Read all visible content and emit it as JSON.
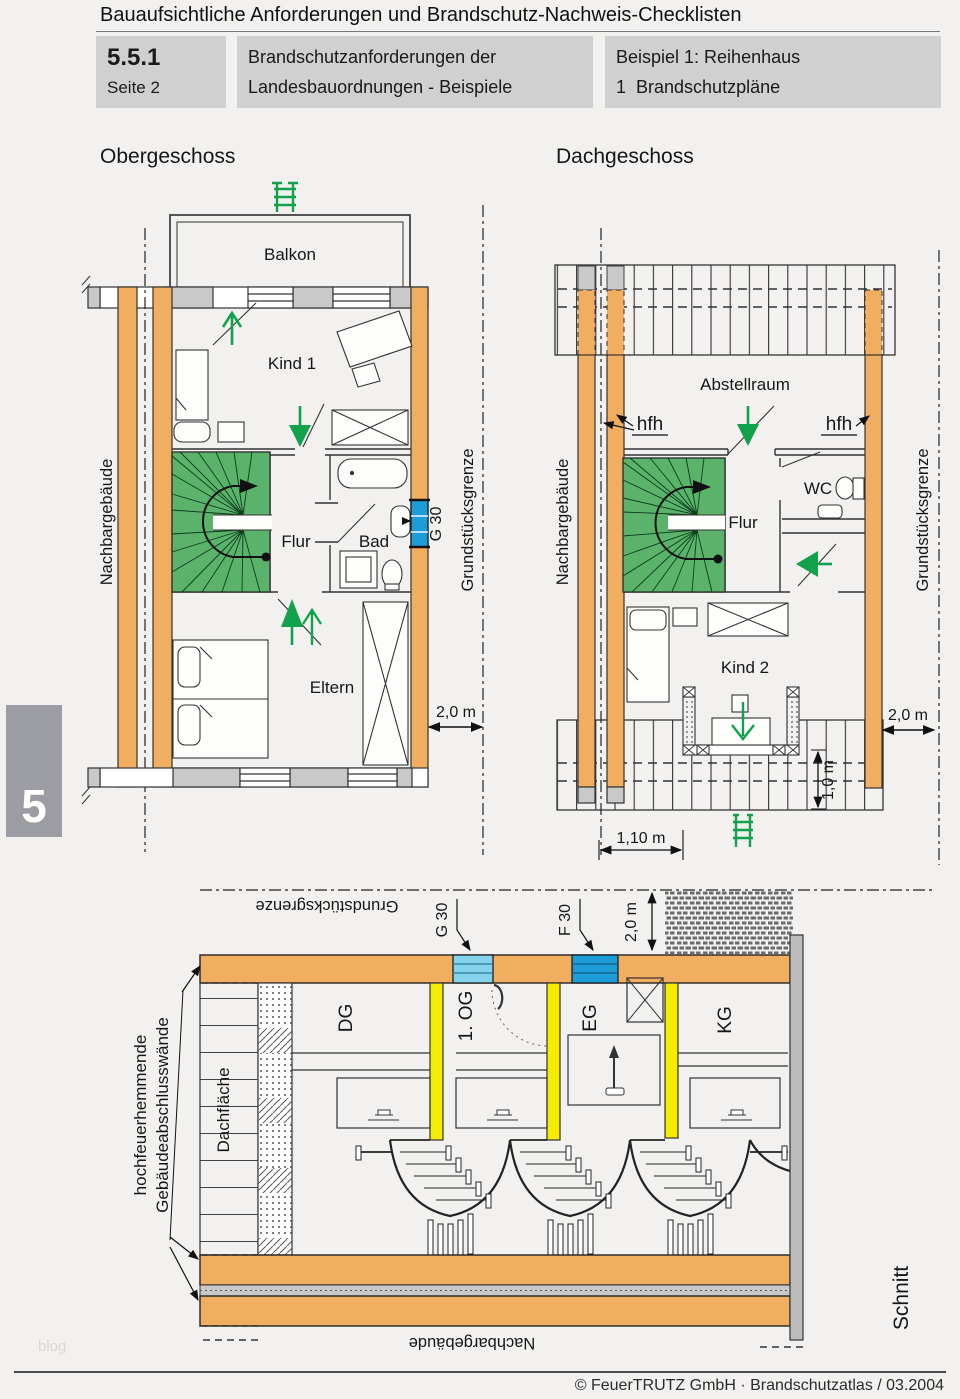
{
  "header": {
    "title": "Bauaufsichtliche Anforderungen und Brandschutz-Nachweis-Checklisten",
    "section_number": "5.5.1",
    "section_page": "Seite 2",
    "topic_line1": "Brandschutzanforderungen der",
    "topic_line2": "Landesbauordnungen - Beispiele",
    "example_line1": "Beispiel 1: Reihenhaus",
    "example_line2": "1  Brandschutzpläne"
  },
  "chapter_tab": "5",
  "watermark": "blog",
  "footer": "© FeuerTRUTZ GmbH · Brandschutzatlas / 03.2004",
  "plans": {
    "obergeschoss": {
      "title": "Obergeschoss",
      "rooms": {
        "balkon": "Balkon",
        "kind1": "Kind 1",
        "flur": "Flur",
        "bad": "Bad",
        "eltern": "Eltern"
      },
      "labels": {
        "left_boundary": "Nachbargebäude",
        "right_boundary": "Grundstücksgrenze",
        "glazing": "G 30",
        "dim_right": "2,0 m"
      }
    },
    "dachgeschoss": {
      "title": "Dachgeschoss",
      "rooms": {
        "abstellraum": "Abstellraum",
        "flur": "Flur",
        "wc": "WC",
        "kind2": "Kind 2"
      },
      "labels": {
        "left_boundary": "Nachbargebäude",
        "right_boundary": "Grundstücksgrenze",
        "hfh_left": "hfh",
        "hfh_right": "hfh",
        "dim_right": "2,0 m",
        "dim_dormer": "1,0 m",
        "dim_bottom": "1,10 m"
      }
    },
    "schnitt": {
      "title": "Schnitt",
      "labels": {
        "boundary_top": "Grundstücksgrenze",
        "g30": "G 30",
        "f30": "F 30",
        "dim_top": "2,0 m",
        "floors": [
          "DG",
          "1. OG",
          "EG",
          "KG"
        ],
        "roof_surface": "Dachfläche",
        "wall_note_line1": "hochfeuerhemmende",
        "wall_note_line2": "Gebäudeabschlusswände",
        "neighbor_bottom": "Nachbargebäude"
      }
    }
  },
  "colors": {
    "wall_orange": "#f2ae60",
    "stair_green": "#5bb26b",
    "arrow_green": "#12a24b",
    "glazing_blue": "#1e9cd7",
    "glazing_lightblue": "#85d2ec",
    "door_yellow": "#f6ec00",
    "window_gray": "#c9c9c9",
    "box_gray": "#d0d0d0"
  }
}
